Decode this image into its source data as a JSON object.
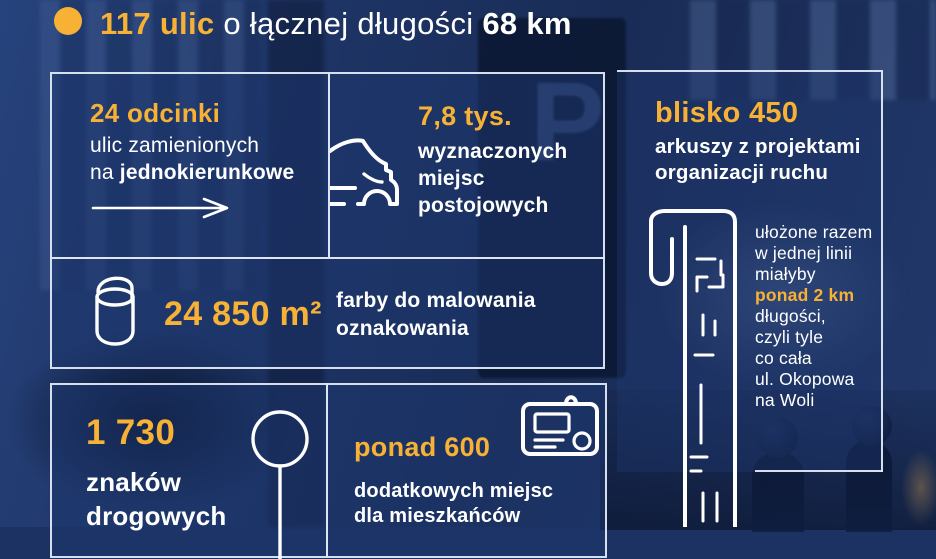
{
  "header": {
    "title_highlight": "117 ulic",
    "title_mid": " o łącznej długości ",
    "title_bold": "68 km"
  },
  "background": {
    "meter_letter": "P"
  },
  "stats": {
    "one_way": {
      "value": "24 odcinki",
      "line1": "ulic zamienionych",
      "line2_prefix": "na ",
      "line2_bold": "jednokierunkowe",
      "icon": "arrow-right"
    },
    "spots": {
      "value": "7,8 tys.",
      "lines": [
        "wyznaczonych",
        "miejsc",
        "postojowych"
      ],
      "icon": "car"
    },
    "paint": {
      "value": "24 850 m²",
      "lines": [
        "farby do malowania",
        "oznakowania"
      ],
      "icon": "paint-bucket"
    },
    "signs": {
      "value": "1 730",
      "lines": [
        "znaków",
        "drogowych"
      ],
      "icon": "road-sign"
    },
    "residents": {
      "value": "ponad 600",
      "lines": [
        "dodatkowych miejsc",
        "dla mieszkańców"
      ],
      "icon": "permit-card"
    },
    "sheets": {
      "value": "blisko 450",
      "lines": [
        "arkuszy z projektami",
        "organizacji ruchu"
      ],
      "icon": "rolled-plans",
      "note_lines": [
        "ułożone razem",
        "w jednej linii",
        "miałyby"
      ],
      "note_highlight": "ponad 2 km",
      "note_tail": [
        "długości,",
        "czyli tyle",
        "co cała",
        "ul. Okopowa",
        "na Woli"
      ]
    }
  },
  "colors": {
    "accent": "#f7b236",
    "text": "#ffffff",
    "background_navy": "#1c3263",
    "box_border": "#e6eefa"
  }
}
